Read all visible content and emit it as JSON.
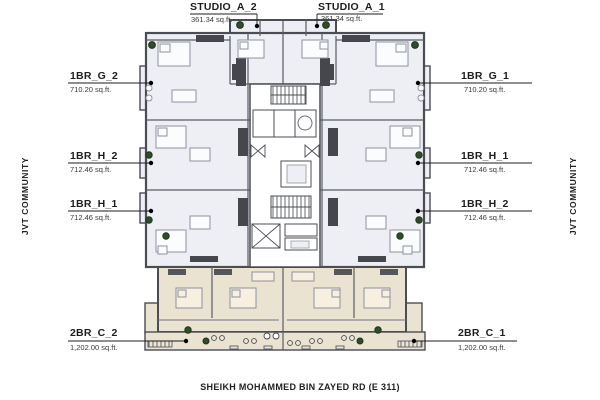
{
  "floor_plan": {
    "units": {
      "studio_a_2": {
        "name": "STUDIO_A_2",
        "area": "361.34 sq.ft."
      },
      "studio_a_1": {
        "name": "STUDIO_A_1",
        "area": "361.34 sq.ft."
      },
      "g2": {
        "name": "1BR_G_2",
        "area": "710.20 sq.ft."
      },
      "g1": {
        "name": "1BR_G_1",
        "area": "710.20 sq.ft."
      },
      "h2_left": {
        "name": "1BR_H_2",
        "area": "712.46 sq.ft."
      },
      "h1_left": {
        "name": "1BR_H_1",
        "area": "712.46 sq.ft."
      },
      "h1_right": {
        "name": "1BR_H_1",
        "area": "712.46 sq.ft."
      },
      "h2_right": {
        "name": "1BR_H_2",
        "area": "712.46 sq.ft."
      },
      "c2": {
        "name": "2BR_C_2",
        "area": "1,202.00 sq.ft."
      },
      "c1": {
        "name": "2BR_C_1",
        "area": "1,202.00 sq.ft."
      }
    },
    "surroundings": {
      "left": "JVT COMMUNITY",
      "right": "JVT COMMUNITY",
      "bottom": "SHEIKH MOHAMMED BIN ZAYED RD (E 311)"
    },
    "colors": {
      "walls": "#4b4d55",
      "upper_units_fill": "#edeff4",
      "lower_units_fill": "#ebe3d1",
      "core_fill": "#ffffff",
      "plants": "#2f4d2a",
      "leader": "#1c1c1c"
    }
  }
}
